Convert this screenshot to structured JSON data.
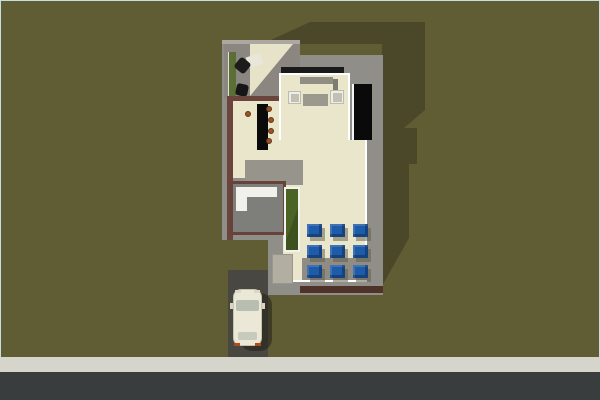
{
  "view": {
    "name": "aerial-top-down-render",
    "description": "Top-down 3D render of a small flat-roof house plan with side deck, kitchen island with stools, living furniture, courtyard planter, 3x3 grid of blue patio cushions, driveway with parked car, sidewalk and street",
    "width": 600,
    "height": 400
  },
  "palette": {
    "grass": "#605D34",
    "cast_shadow": "#4A4829",
    "concrete": "#8F8E89",
    "deck_gray": "#8B8780",
    "wall_brown": "#6B453C",
    "wall_dark_band": "#4F3329",
    "floor_cream": "#EAE6CB",
    "outline_white": "#FFFFFF",
    "accent_blue": "#1E5BA8",
    "planter_green": "#4C6326",
    "hedge_green": "#5A6E35",
    "road_asphalt": "#3A3D3E",
    "sidewalk": "#D6D5CB",
    "driveway": "#484742",
    "car_cream": "#ECE8D7",
    "stool_brown": "#9B5526",
    "counter_black": "#0A0A0A"
  },
  "scene": {
    "background": "#605D34",
    "objects": [
      {
        "name": "building-cast-shadow",
        "x": 0,
        "y": 0,
        "w": 600,
        "h": 400,
        "color": "#4A4829",
        "clip": [
          [
            262,
            44
          ],
          [
            310,
            22
          ],
          [
            425,
            22
          ],
          [
            425,
            110
          ],
          [
            404,
            128
          ],
          [
            417,
            128
          ],
          [
            417,
            164
          ],
          [
            409,
            164
          ],
          [
            409,
            238
          ],
          [
            382,
            286
          ],
          [
            382,
            44
          ]
        ],
        "inter": false
      },
      {
        "name": "sidewalk",
        "x": 0,
        "y": 357,
        "w": 600,
        "h": 16,
        "color": "#D6D5CB",
        "cls": "speckle",
        "inter": false
      },
      {
        "name": "road",
        "x": 0,
        "y": 372,
        "w": 600,
        "h": 28,
        "color": "#3A3D3E",
        "inter": false
      },
      {
        "name": "driveway",
        "x": 228,
        "y": 270,
        "w": 40,
        "h": 87,
        "color": "#484742",
        "inter": false
      },
      {
        "name": "car-shadow",
        "x": 240,
        "y": 293,
        "w": 32,
        "h": 58,
        "color": "rgba(35,33,24,0.55)",
        "r": "12px",
        "inter": false
      },
      {
        "name": "house-footprint-slab",
        "x": 0,
        "y": 0,
        "w": 600,
        "h": 400,
        "color": "#8F8E89",
        "clip": [
          [
            222,
            40
          ],
          [
            300,
            40
          ],
          [
            300,
            55
          ],
          [
            383,
            55
          ],
          [
            383,
            295
          ],
          [
            268,
            295
          ],
          [
            268,
            240
          ],
          [
            222,
            240
          ]
        ],
        "inter": false
      },
      {
        "name": "deck-top-edge",
        "x": 222,
        "y": 40,
        "w": 78,
        "h": 4,
        "color": "#ACA8A1",
        "inter": false
      },
      {
        "name": "side-deck",
        "x": 224,
        "y": 44,
        "w": 76,
        "h": 54,
        "color": "#8B8780",
        "inter": false
      },
      {
        "name": "deck-sail-panel",
        "x": 224,
        "y": 44,
        "w": 76,
        "h": 54,
        "color": "#E7E3C9",
        "clip": [
          [
            26,
            0
          ],
          [
            69,
            0
          ],
          [
            26,
            52
          ]
        ],
        "inter": false
      },
      {
        "name": "deck-hedge-planter",
        "x": 228,
        "y": 52,
        "w": 8,
        "h": 44,
        "color": "#5A6E35",
        "border": "1px solid #E0E0D8",
        "sides": "l",
        "inter": true
      },
      {
        "name": "deck-desk",
        "x": 247,
        "y": 55,
        "w": 15,
        "h": 11,
        "color": "#E9E6DA",
        "rot": -18,
        "inter": true
      },
      {
        "name": "office-chair-1",
        "x": 236,
        "y": 59,
        "w": 13,
        "h": 13,
        "color": "#1C1C1C",
        "r": "3px",
        "rot": 40,
        "inter": true
      },
      {
        "name": "office-chair-2",
        "x": 236,
        "y": 84,
        "w": 12,
        "h": 12,
        "color": "#161616",
        "r": "3px",
        "rot": 12,
        "inter": true
      },
      {
        "name": "exterior-wall-left",
        "x": 227,
        "y": 96,
        "w": 6,
        "h": 144,
        "color": "#6B453C",
        "inter": false
      },
      {
        "name": "exterior-wall-kitchen-top",
        "x": 227,
        "y": 96,
        "w": 60,
        "h": 5,
        "color": "#6B453C",
        "inter": false
      },
      {
        "name": "kitchen-floor",
        "x": 233,
        "y": 101,
        "w": 50,
        "h": 77,
        "color": "#EAE6CB",
        "cls": "stripes",
        "inter": false
      },
      {
        "name": "living-header-beam",
        "x": 281,
        "y": 67,
        "w": 63,
        "h": 6,
        "color": "#1A1A1A",
        "inter": false
      },
      {
        "name": "living-room-floor",
        "x": 279,
        "y": 73,
        "w": 71,
        "h": 67,
        "color": "#EAE6CB",
        "cls": "stripes",
        "border": "2px solid #FFFFFF",
        "sides": "trl",
        "inter": false
      },
      {
        "name": "stair-void",
        "x": 352,
        "y": 84,
        "w": 20,
        "h": 56,
        "color": "#0A0A0A",
        "border": "2px solid #F5F5F5",
        "sides": "l",
        "inter": false
      },
      {
        "name": "great-room-floor",
        "x": 283,
        "y": 140,
        "w": 84,
        "h": 142,
        "color": "#EAE6CB",
        "cls": "stripes",
        "border": "2px solid #FFFFFF",
        "sides": "rb",
        "inter": false
      },
      {
        "name": "hall-landing",
        "x": 245,
        "y": 160,
        "w": 58,
        "h": 25,
        "color": "#97948B",
        "inter": false
      },
      {
        "name": "bathroom",
        "x": 230,
        "y": 181,
        "w": 56,
        "h": 54,
        "color": "#7E7E7A",
        "border": "3px solid #66423A",
        "inter": false
      },
      {
        "name": "bathroom-vanity",
        "x": 236,
        "y": 187,
        "w": 41,
        "h": 10,
        "color": "#F1F1EB",
        "inter": false
      },
      {
        "name": "bathroom-shower",
        "x": 236,
        "y": 187,
        "w": 11,
        "h": 24,
        "color": "#F1F1EB",
        "inter": false
      },
      {
        "name": "courtyard-planter",
        "x": 284,
        "y": 187,
        "w": 16,
        "h": 65,
        "gradient": "linear-gradient(110deg,#4C6326 55%,#3E5220 55%)",
        "border": "2px solid #F2F2EE",
        "inter": true
      },
      {
        "name": "entry-mat",
        "x": 272,
        "y": 254,
        "w": 21,
        "h": 30,
        "color": "#B2AFA2",
        "cls": "mat",
        "border": "1px solid #99968B",
        "inter": false
      },
      {
        "name": "rear-wall-band",
        "x": 300,
        "y": 286,
        "w": 83,
        "h": 7,
        "color": "#4F3329",
        "inter": false
      },
      {
        "name": "kitchen-island",
        "x": 257,
        "y": 104,
        "w": 11,
        "h": 46,
        "color": "#0A0A0A",
        "inter": true
      },
      {
        "name": "bar-stool-1",
        "x": 245,
        "y": 111,
        "w": 6,
        "h": 6,
        "color": "#9B5526",
        "r": "50%",
        "border": "1px solid #63351A",
        "inter": true
      },
      {
        "name": "bar-stool-2",
        "x": 266,
        "y": 106,
        "w": 6,
        "h": 6,
        "color": "#9B5526",
        "r": "50%",
        "border": "1px solid #63351A",
        "inter": true
      },
      {
        "name": "bar-stool-3",
        "x": 268,
        "y": 117,
        "w": 6,
        "h": 6,
        "color": "#9B5526",
        "r": "50%",
        "border": "1px solid #63351A",
        "inter": true
      },
      {
        "name": "bar-stool-4",
        "x": 268,
        "y": 128,
        "w": 6,
        "h": 6,
        "color": "#9B5526",
        "r": "50%",
        "border": "1px solid #63351A",
        "inter": true
      },
      {
        "name": "bar-stool-5",
        "x": 266,
        "y": 138,
        "w": 6,
        "h": 6,
        "color": "#9B5526",
        "r": "50%",
        "border": "1px solid #63351A",
        "inter": true
      },
      {
        "name": "sofa-back",
        "x": 300,
        "y": 77,
        "w": 33,
        "h": 8,
        "color": "#908D83",
        "inter": false
      },
      {
        "name": "sofa",
        "x": 300,
        "y": 84,
        "w": 33,
        "h": 15,
        "color": "#E9E5C9",
        "inter": true
      },
      {
        "name": "sofa-shadow",
        "x": 333,
        "y": 79,
        "w": 5,
        "h": 19,
        "color": "#7E7B71",
        "inter": false
      },
      {
        "name": "living-rug",
        "x": 303,
        "y": 94,
        "w": 25,
        "h": 12,
        "color": "#9B988D",
        "inter": false
      },
      {
        "name": "armchair-left",
        "x": 288,
        "y": 91,
        "w": 13,
        "h": 13,
        "color": "#EFEEE4",
        "border": "1px solid #BDBAB0",
        "inter": true
      },
      {
        "name": "armchair-left-seat",
        "x": 291,
        "y": 94,
        "w": 8,
        "h": 8,
        "color": "#C2BFB4",
        "inter": false
      },
      {
        "name": "armchair-right",
        "x": 330,
        "y": 90,
        "w": 14,
        "h": 14,
        "color": "#EFEEE4",
        "border": "1px solid #BDBAB0",
        "inter": true
      },
      {
        "name": "armchair-right-seat",
        "x": 333,
        "y": 93,
        "w": 9,
        "h": 9,
        "color": "#C2BFB4",
        "inter": false
      },
      {
        "name": "patio-terrace",
        "x": 302,
        "y": 258,
        "w": 65,
        "h": 22,
        "color": "#8F8C83",
        "inter": false
      },
      {
        "name": "patio-cushion-1",
        "x": 307,
        "y": 224,
        "w": 15,
        "h": 13,
        "color": "#1E5BA8",
        "cls": "cushion",
        "inter": true
      },
      {
        "name": "patio-cushion-2",
        "x": 330,
        "y": 224,
        "w": 15,
        "h": 13,
        "color": "#1E5BA8",
        "cls": "cushion",
        "inter": true
      },
      {
        "name": "patio-cushion-3",
        "x": 353,
        "y": 224,
        "w": 15,
        "h": 13,
        "color": "#1E5BA8",
        "cls": "cushion",
        "inter": true
      },
      {
        "name": "patio-cushion-4",
        "x": 307,
        "y": 245,
        "w": 15,
        "h": 13,
        "color": "#1E5BA8",
        "cls": "cushion",
        "inter": true
      },
      {
        "name": "patio-cushion-5",
        "x": 330,
        "y": 245,
        "w": 15,
        "h": 13,
        "color": "#1E5BA8",
        "cls": "cushion",
        "inter": true
      },
      {
        "name": "patio-cushion-6",
        "x": 353,
        "y": 245,
        "w": 15,
        "h": 13,
        "color": "#1E5BA8",
        "cls": "cushion",
        "inter": true
      },
      {
        "name": "patio-cushion-7",
        "x": 307,
        "y": 265,
        "w": 15,
        "h": 13,
        "color": "#1E5BA8",
        "cls": "cushion",
        "inter": true
      },
      {
        "name": "patio-cushion-8",
        "x": 330,
        "y": 265,
        "w": 15,
        "h": 13,
        "color": "#1E5BA8",
        "cls": "cushion",
        "inter": true
      },
      {
        "name": "patio-cushion-9",
        "x": 353,
        "y": 265,
        "w": 15,
        "h": 13,
        "color": "#1E5BA8",
        "cls": "cushion",
        "inter": true
      },
      {
        "name": "car-body",
        "x": 233,
        "y": 289,
        "w": 29,
        "h": 57,
        "color": "#ECE8D7",
        "r": "8px",
        "border": "1px solid #C9C3AB",
        "inter": true
      },
      {
        "name": "car-windshield",
        "x": 236,
        "y": 300,
        "w": 23,
        "h": 11,
        "color": "#B9BFB0",
        "r": "2px",
        "inter": false
      },
      {
        "name": "car-rear-window",
        "x": 238,
        "y": 332,
        "w": 19,
        "h": 8,
        "color": "#C6CBBB",
        "r": "2px",
        "inter": false
      },
      {
        "name": "car-headlight-left",
        "x": 235,
        "y": 290,
        "w": 6,
        "h": 3,
        "color": "#DCD8C4",
        "inter": false
      },
      {
        "name": "car-headlight-right",
        "x": 254,
        "y": 290,
        "w": 6,
        "h": 3,
        "color": "#DCD8C4",
        "inter": false
      },
      {
        "name": "car-taillight-left",
        "x": 234,
        "y": 343,
        "w": 6,
        "h": 3,
        "color": "#B34A1E",
        "inter": false
      },
      {
        "name": "car-taillight-right",
        "x": 255,
        "y": 343,
        "w": 6,
        "h": 3,
        "color": "#B34A1E",
        "inter": false
      },
      {
        "name": "car-mirror-left",
        "x": 230,
        "y": 303,
        "w": 3,
        "h": 6,
        "color": "#D9D5C5",
        "inter": false
      },
      {
        "name": "car-mirror-right",
        "x": 262,
        "y": 303,
        "w": 3,
        "h": 6,
        "color": "#D9D5C5",
        "inter": false
      }
    ]
  }
}
